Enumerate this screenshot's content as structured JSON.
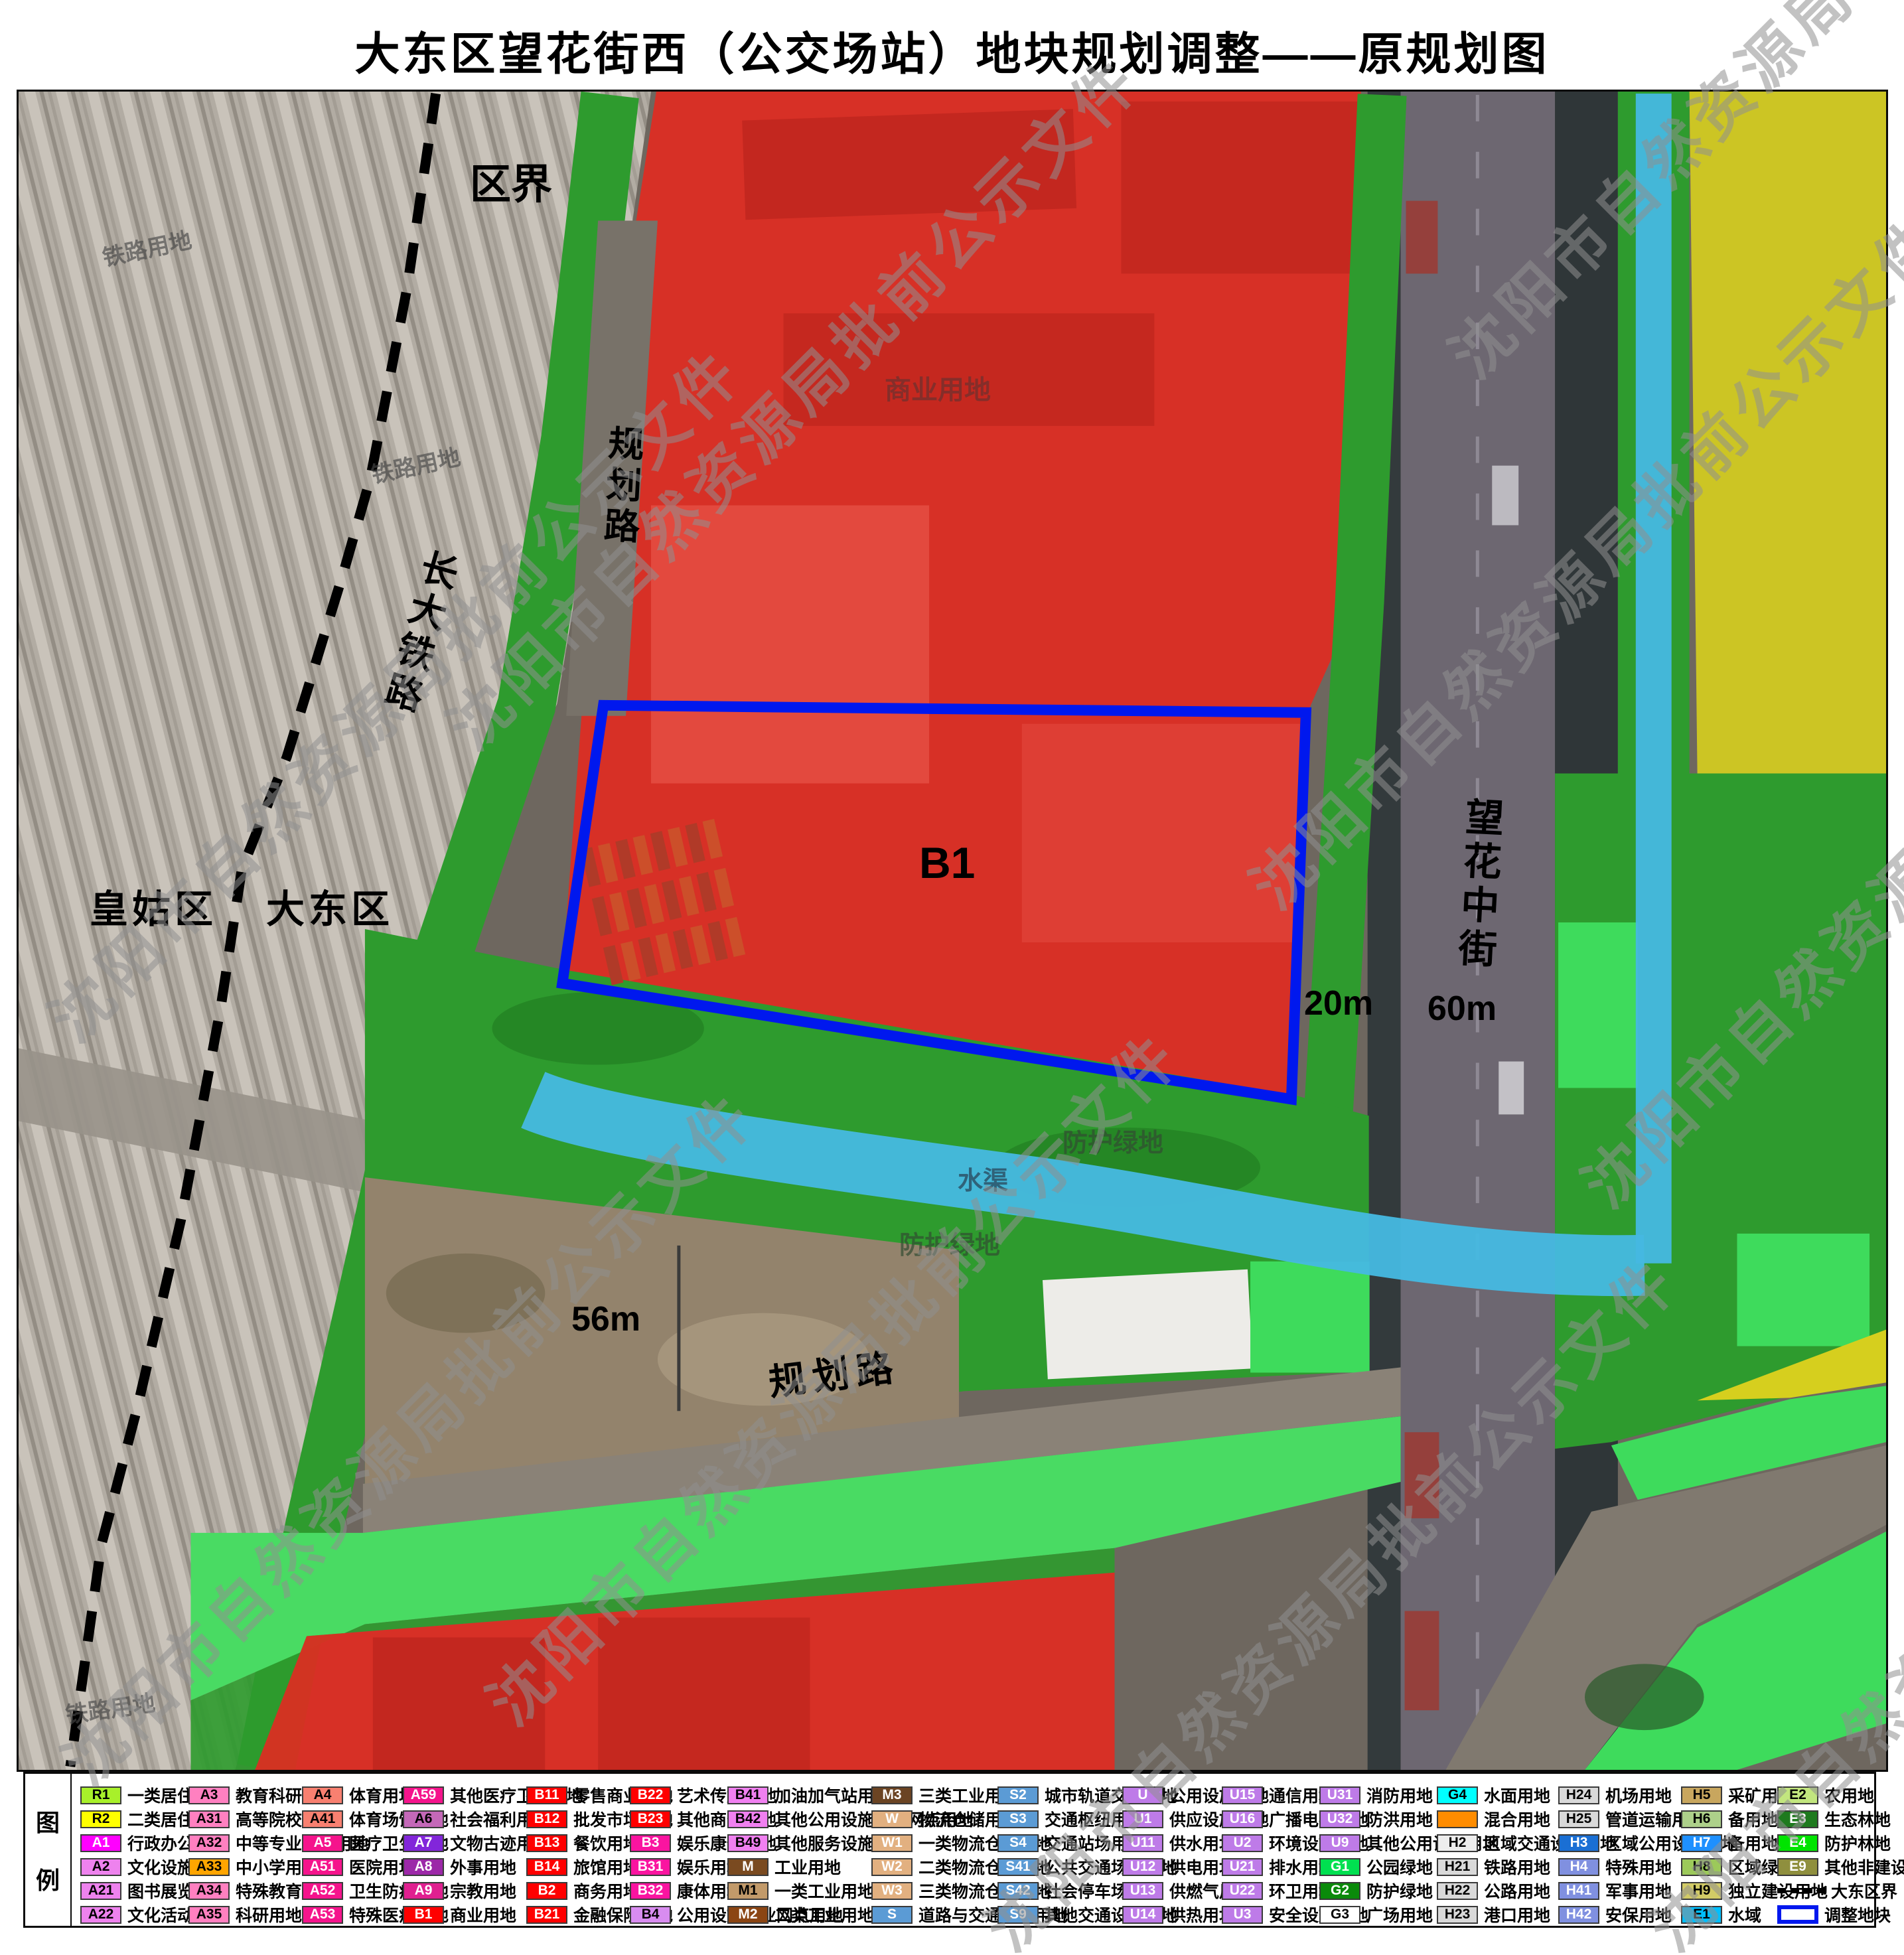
{
  "title": "大东区望花街西（公交场站）地块规划调整——原规划图",
  "watermark": {
    "text": "沈阳市自然资源局批前公示文件"
  },
  "colors": {
    "commercial_red": "#df2b22",
    "protective_green": "#2e9b2e",
    "light_green": "#49db63",
    "bright_green": "#3edb5c",
    "residential_yellow": "#d6cf1e",
    "water_cyan": "#46b9e2",
    "parcel_outline_blue": "#0018ee",
    "boundary_black": "#000000"
  },
  "map": {
    "labels": {
      "district_boundary": "区界",
      "planned_road_top": "规划路",
      "railway_name": "长大铁路",
      "huanggu_district": "皇姑区",
      "dadong_district": "大东区",
      "parcel_code": "B1",
      "width_20m": "20m",
      "width_60m": "60m",
      "width_56m": "56m",
      "wanghua_middle_street": "望花中街",
      "planned_road_bottom": "规划路"
    },
    "faint_labels": {
      "railway_use_1": "铁路用地",
      "railway_use_2": "铁路用地",
      "railway_use_3": "铁路用地",
      "commercial_use": "商业用地",
      "protective_green_1": "防护绿地",
      "water_channel": "水渠",
      "protective_green_2": "防护绿地"
    }
  },
  "legend": {
    "panel_label_top": "图",
    "panel_label_bottom": "例",
    "columns": [
      [
        {
          "code": "R1",
          "label": "一类居住用地",
          "color": "#a8f02a"
        },
        {
          "code": "R2",
          "label": "二类居住用地",
          "color": "#ffff00"
        },
        {
          "code": "A1",
          "label": "行政办公用地",
          "color": "#ff00ff"
        },
        {
          "code": "A2",
          "label": "文化设施用地",
          "color": "#ee82ee"
        },
        {
          "code": "A21",
          "label": "图书展览用地",
          "color": "#ee82ee"
        },
        {
          "code": "A22",
          "label": "文化活动用地",
          "color": "#ee82ee"
        }
      ],
      [
        {
          "code": "A3",
          "label": "教育科研用地",
          "color": "#ff80c0"
        },
        {
          "code": "A31",
          "label": "高等院校用地",
          "color": "#ff80c0"
        },
        {
          "code": "A32",
          "label": "中等专业学校用地",
          "color": "#ff80c0"
        },
        {
          "code": "A33",
          "label": "中小学用地",
          "color": "#ffa500"
        },
        {
          "code": "A34",
          "label": "特殊教育用地",
          "color": "#ff80c0"
        },
        {
          "code": "A35",
          "label": "科研用地",
          "color": "#ff80c0"
        }
      ],
      [
        {
          "code": "A4",
          "label": "体育用地",
          "color": "#f88070"
        },
        {
          "code": "A41",
          "label": "体育场馆用地",
          "color": "#f88070"
        },
        {
          "code": "A5",
          "label": "医疗卫生用地",
          "color": "#f5148c"
        },
        {
          "code": "A51",
          "label": "医院用地",
          "color": "#f5148c"
        },
        {
          "code": "A52",
          "label": "卫生防疫用地",
          "color": "#f5148c"
        },
        {
          "code": "A53",
          "label": "特殊医疗用地",
          "color": "#f5148c"
        }
      ],
      [
        {
          "code": "A59",
          "label": "其他医疗卫生用地",
          "color": "#f5148c"
        },
        {
          "code": "A6",
          "label": "社会福利用地",
          "color": "#c468b8",
          "tc": "#000000"
        },
        {
          "code": "A7",
          "label": "文物古迹用地",
          "color": "#8226da"
        },
        {
          "code": "A8",
          "label": "外事用地",
          "color": "#9c28a8"
        },
        {
          "code": "A9",
          "label": "宗教用地",
          "color": "#e02090"
        },
        {
          "code": "B1",
          "label": "商业用地",
          "color": "#ff0000"
        }
      ],
      [
        {
          "code": "B11",
          "label": "零售商业用地",
          "color": "#ff0000"
        },
        {
          "code": "B12",
          "label": "批发市场用地",
          "color": "#ff0000"
        },
        {
          "code": "B13",
          "label": "餐饮用地",
          "color": "#ff0000"
        },
        {
          "code": "B14",
          "label": "旅馆用地",
          "color": "#ff0000"
        },
        {
          "code": "B2",
          "label": "商务用地",
          "color": "#ff0000"
        },
        {
          "code": "B21",
          "label": "金融保险用地",
          "color": "#ff0000"
        }
      ],
      [
        {
          "code": "B22",
          "label": "艺术传媒用地",
          "color": "#ff0000"
        },
        {
          "code": "B23",
          "label": "其他商务用地",
          "color": "#ff0000"
        },
        {
          "code": "B3",
          "label": "娱乐康体用地",
          "color": "#fa14a0"
        },
        {
          "code": "B31",
          "label": "娱乐用地",
          "color": "#fa14a0"
        },
        {
          "code": "B32",
          "label": "康体用地",
          "color": "#fa14a0"
        },
        {
          "code": "B4",
          "label": "公用设施营业网点用地",
          "color": "#d88cf0"
        }
      ],
      [
        {
          "code": "B41",
          "label": "加油加气站用地",
          "color": "#f080f0"
        },
        {
          "code": "B42",
          "label": "其他公用设施营业网点用地",
          "color": "#f080f0"
        },
        {
          "code": "B49",
          "label": "其他服务设施用地",
          "color": "#f080f0"
        },
        {
          "code": "M",
          "label": "工业用地",
          "color": "#7a4a20"
        },
        {
          "code": "M1",
          "label": "一类工业用地",
          "color": "#c29a6a"
        },
        {
          "code": "M2",
          "label": "二类工业用地",
          "color": "#8b4513"
        }
      ],
      [
        {
          "code": "M3",
          "label": "三类工业用地",
          "color": "#6b4423"
        },
        {
          "code": "W",
          "label": "物流仓储用地",
          "color": "#e2b080",
          "tc": "#ffffff"
        },
        {
          "code": "W1",
          "label": "一类物流仓储用地",
          "color": "#e2b080",
          "tc": "#ffffff"
        },
        {
          "code": "W2",
          "label": "二类物流仓储用地",
          "color": "#e2b080",
          "tc": "#ffffff"
        },
        {
          "code": "W3",
          "label": "三类物流仓储用地",
          "color": "#e2b080",
          "tc": "#ffffff"
        },
        {
          "code": "S",
          "label": "道路与交通设施用地",
          "color": "#5b9bd5"
        }
      ],
      [
        {
          "code": "S2",
          "label": "城市轨道交通用地",
          "color": "#5b9bd5"
        },
        {
          "code": "S3",
          "label": "交通枢纽用地",
          "color": "#5b9bd5"
        },
        {
          "code": "S4",
          "label": "交通站场用地",
          "color": "#5b9bd5"
        },
        {
          "code": "S41",
          "label": "公共交通场站用地",
          "color": "#5b9bd5"
        },
        {
          "code": "S42",
          "label": "社会停车场用地",
          "color": "#5b9bd5"
        },
        {
          "code": "S9",
          "label": "其他交通设施用地",
          "color": "#5b9bd5"
        }
      ],
      [
        {
          "code": "U",
          "label": "公用设施用地",
          "color": "#be7be8"
        },
        {
          "code": "U1",
          "label": "供应设施用地",
          "color": "#be7be8"
        },
        {
          "code": "U11",
          "label": "供水用地",
          "color": "#be7be8"
        },
        {
          "code": "U12",
          "label": "供电用地",
          "color": "#be7be8"
        },
        {
          "code": "U13",
          "label": "供燃气用地",
          "color": "#be7be8"
        },
        {
          "code": "U14",
          "label": "供热用地",
          "color": "#be7be8"
        }
      ],
      [
        {
          "code": "U15",
          "label": "通信用地",
          "color": "#be7be8"
        },
        {
          "code": "U16",
          "label": "广播电视用地",
          "color": "#be7be8"
        },
        {
          "code": "U2",
          "label": "环境设施用地",
          "color": "#be7be8"
        },
        {
          "code": "U21",
          "label": "排水用地",
          "color": "#be7be8"
        },
        {
          "code": "U22",
          "label": "环卫用地",
          "color": "#be7be8"
        },
        {
          "code": "U3",
          "label": "安全设施用地",
          "color": "#be7be8"
        }
      ],
      [
        {
          "code": "U31",
          "label": "消防用地",
          "color": "#be7be8"
        },
        {
          "code": "U32",
          "label": "防洪用地",
          "color": "#be7be8"
        },
        {
          "code": "U9",
          "label": "其他公用设施用地",
          "color": "#be7be8"
        },
        {
          "code": "G1",
          "label": "公园绿地",
          "color": "#00e050"
        },
        {
          "code": "G2",
          "label": "防护绿地",
          "color": "#0a8a0a"
        },
        {
          "code": "G3",
          "label": "广场用地",
          "color": "#ffffff"
        }
      ],
      [
        {
          "code": "G4",
          "label": "水面用地",
          "color": "#00ffff"
        },
        {
          "code": "",
          "label": "混合用地",
          "color": "#ff8c00"
        },
        {
          "code": "H2",
          "label": "区域交通设施用地",
          "color": "#ededed"
        },
        {
          "code": "H21",
          "label": "铁路用地",
          "color": "#d9d9d9"
        },
        {
          "code": "H22",
          "label": "公路用地",
          "color": "#d9d9d9"
        },
        {
          "code": "H23",
          "label": "港口用地",
          "color": "#d9d9d9"
        }
      ],
      [
        {
          "code": "H24",
          "label": "机场用地",
          "color": "#d9d9d9"
        },
        {
          "code": "H25",
          "label": "管道运输用地",
          "color": "#d9d9d9"
        },
        {
          "code": "H3",
          "label": "区域公用设施用地",
          "color": "#1a6fd4"
        },
        {
          "code": "H4",
          "label": "特殊用地",
          "color": "#8090e0"
        },
        {
          "code": "H41",
          "label": "军事用地",
          "color": "#8090e0"
        },
        {
          "code": "H42",
          "label": "安保用地",
          "color": "#8090e0"
        }
      ],
      [
        {
          "code": "H5",
          "label": "采矿用地",
          "color": "#c8a65e"
        },
        {
          "code": "H6",
          "label": "备用地",
          "color": "#add08a"
        },
        {
          "code": "H7",
          "label": "备用地",
          "color": "#1e90ff"
        },
        {
          "code": "H8",
          "label": "区域绿地",
          "color": "#9cc95a"
        },
        {
          "code": "H9",
          "label": "独立建设用地",
          "color": "#d2cb66"
        },
        {
          "code": "E1",
          "label": "水域",
          "color": "#00bfff",
          "tc": "#000000"
        }
      ],
      [
        {
          "code": "E2",
          "label": "农用地",
          "color": "#c2e67e"
        },
        {
          "code": "E3",
          "label": "生态林地",
          "color": "#1e7a1e"
        },
        {
          "code": "E4",
          "label": "防护林地",
          "color": "#00e400"
        },
        {
          "code": "E9",
          "label": "其他非建设用地",
          "color": "#8f8f3e",
          "bold": true
        },
        {
          "sym": "dash",
          "label": "大东区界"
        },
        {
          "sym": "rect",
          "label": "调整地块"
        }
      ]
    ]
  }
}
